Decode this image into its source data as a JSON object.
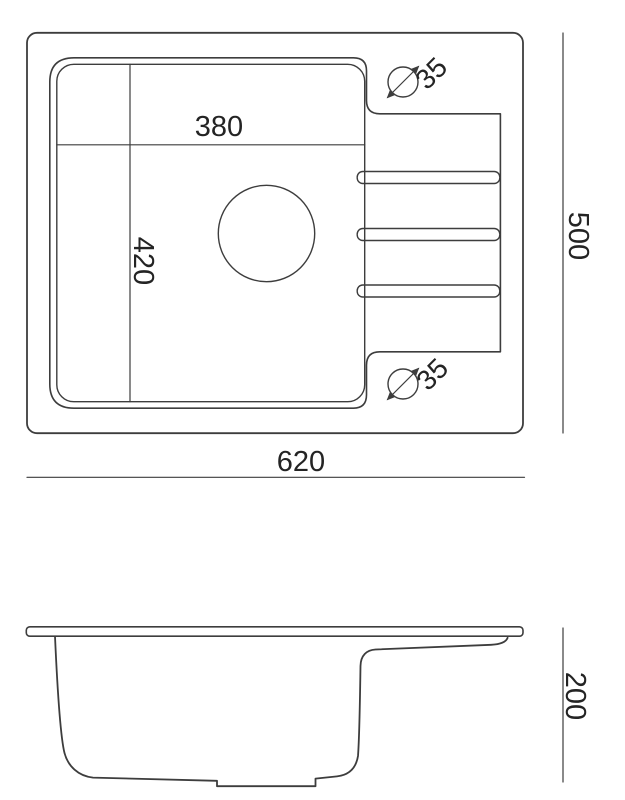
{
  "colors": {
    "line": "#3d3d3d",
    "text": "#242424",
    "background": "#ffffff"
  },
  "drawing_type": "sink technical drawing, top view and side view",
  "top_view": {
    "bowl_width": "380",
    "bowl_depth": "420",
    "overall_width": "620",
    "overall_depth": "500",
    "faucet_hole_top_diameter": "35",
    "faucet_hole_bottom_diameter": "35"
  },
  "side_view": {
    "overall_height": "200"
  }
}
